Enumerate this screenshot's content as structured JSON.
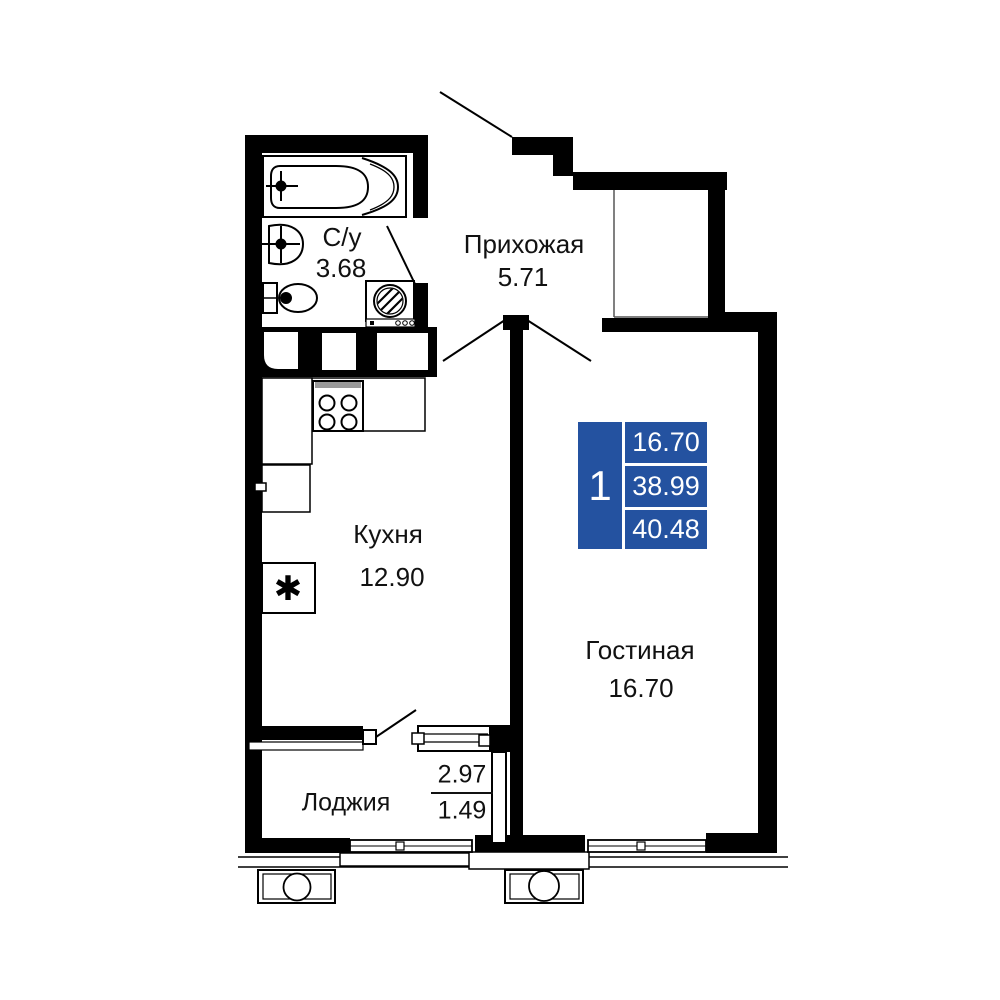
{
  "badge": {
    "rooms_count": "1",
    "room_area": "16.70",
    "area_without_loggia": "38.99",
    "total_area": "40.48"
  },
  "rooms": {
    "bathroom": {
      "label": "С/у",
      "area": "3.68"
    },
    "hallway": {
      "label": "Прихожая",
      "area": "5.71"
    },
    "kitchen": {
      "label": "Кухня",
      "area": "12.90"
    },
    "living_room": {
      "label": "Гостиная",
      "area": "16.70"
    },
    "loggia": {
      "label": "Лоджия",
      "area_full": "2.97",
      "area_counted": "1.49"
    }
  },
  "symbols": {
    "fridge": "✱"
  },
  "colors": {
    "walls": "#000000",
    "badge_blue": "#2452a0",
    "badge_text": "#ffffff",
    "label_text": "#111111"
  }
}
